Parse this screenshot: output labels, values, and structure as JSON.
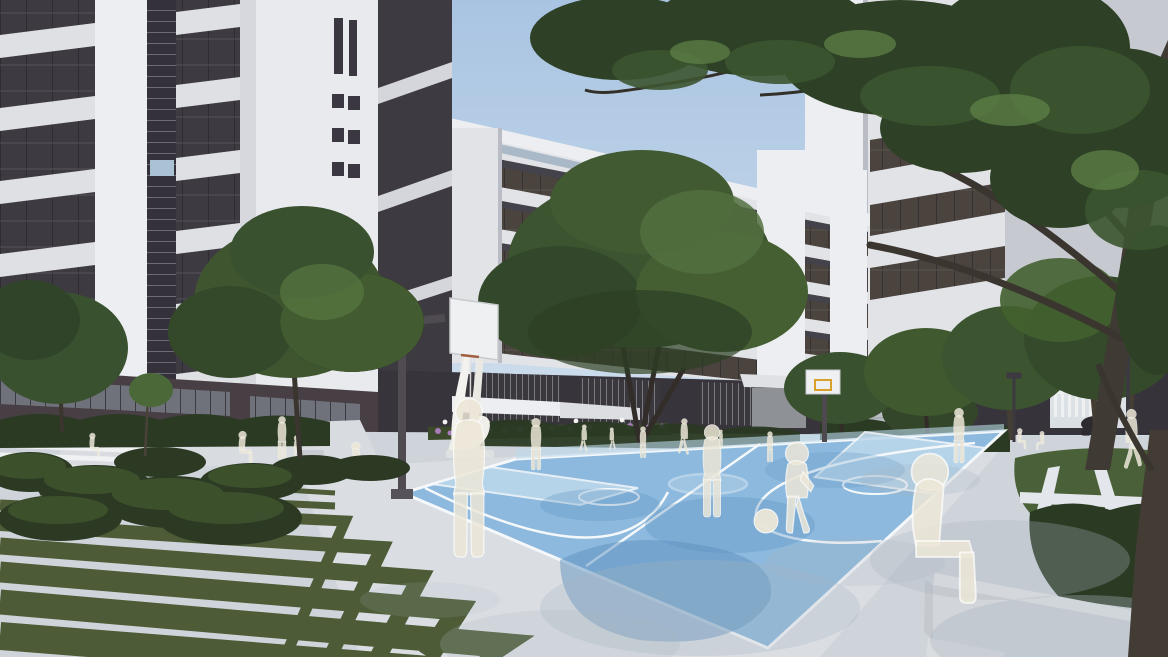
{
  "meta": {
    "title": "Architectural rendering of a campus courtyard with basketball court",
    "style": "3D visualization, no UI text visible"
  },
  "colors": {
    "sky_top": "#a9c4e2",
    "sky_bottom": "#d3e1ee",
    "wall_white": "#e2e3e7",
    "wall_shade": "#c7c9d1",
    "pier_white": "#edeef1",
    "glass_dark": "#3e3a41",
    "glass_brown": "#4a433e",
    "base_dark": "#38343b",
    "base_brown": "#473f44",
    "window_gray": "#70727b",
    "foliage_dark": "#2c3e25",
    "foliage_mid": "#41592f",
    "foliage_light": "#5d7d42",
    "foliage_bright": "#76994f",
    "trunk": "#453e35",
    "trunk_dark": "#322d28",
    "court_blue": "#8cb9dd",
    "court_light": "#bdd8ec",
    "court_shadow": "#5e92bf",
    "line_white": "#f5f8fa",
    "pavement": "#ced4da",
    "pavement_bright": "#dfe3e7",
    "pavement_shadow": "#a9b4c0",
    "grass": "#4d5c36",
    "grass_dark": "#39452a",
    "figure": "#ece6d7",
    "bench_white": "#e7e8ea",
    "bench_side": "#d2d5d9",
    "hedge": "#2a3a23",
    "flower_purple": "#a87cba",
    "lamp": "#f4f4f2",
    "accent_red": "#b04a42",
    "accent_blue": "#4c6ea6",
    "metal_dark": "#4d494f",
    "passage_light": "#d9dee3",
    "scooter": "#2e2b30",
    "backboard_yellow": "#d9a02b"
  },
  "scene": {
    "buildings": [
      "white multi-storey block left",
      "white slab building center",
      "white tower right"
    ],
    "objects": [
      "basketball court",
      "near basketball hoop",
      "far basketball hoop",
      "abstract white sculpture",
      "chevron grass stripes",
      "white concrete bench",
      "flower bed",
      "passage with white fence",
      "parked scooter"
    ],
    "people": "translucent white ghost silhouettes"
  },
  "court": {
    "corners": [
      [
        403,
        493
      ],
      [
        516,
        459
      ],
      [
        1004,
        431
      ],
      [
        768,
        648
      ]
    ],
    "ball": {
      "x": 766,
      "y": 521,
      "r": 12
    }
  },
  "landscape": {
    "grass_strips": [
      {
        "p": [
          [
            118,
            480
          ],
          [
            335,
            493
          ]
        ],
        "w": 5
      },
      {
        "p": [
          [
            40,
            492
          ],
          [
            335,
            506
          ]
        ],
        "w": 7
      },
      {
        "p": [
          [
            0,
            505
          ],
          [
            345,
            521
          ],
          [
            285,
            657
          ]
        ],
        "w": 11
      },
      {
        "p": [
          [
            0,
            524
          ],
          [
            382,
            548
          ],
          [
            330,
            657
          ]
        ],
        "w": 14
      },
      {
        "p": [
          [
            0,
            546
          ],
          [
            420,
            578
          ],
          [
            378,
            657
          ]
        ],
        "w": 17
      },
      {
        "p": [
          [
            0,
            572
          ],
          [
            458,
            610
          ],
          [
            428,
            657
          ]
        ],
        "w": 21
      },
      {
        "p": [
          [
            0,
            602
          ],
          [
            498,
            645
          ],
          [
            480,
            657
          ]
        ],
        "w": 25
      },
      {
        "p": [
          [
            0,
            636
          ],
          [
            530,
            678
          ]
        ],
        "w": 28
      }
    ]
  },
  "figures": [
    {
      "t": "sit",
      "x": 95,
      "y": 457,
      "s": 0.37,
      "f": 1
    },
    {
      "t": "sit",
      "x": 246,
      "y": 463,
      "s": 0.49,
      "f": 1
    },
    {
      "t": "stand",
      "x": 282,
      "y": 459,
      "s": 0.42,
      "f": 1
    },
    {
      "t": "child",
      "x": 297,
      "y": 459,
      "s": 0.4,
      "f": 1
    },
    {
      "t": "sit",
      "x": 352,
      "y": 478,
      "s": 0.55,
      "f": -1
    },
    {
      "t": "stand",
      "x": 469,
      "y": 557,
      "s": 1.56,
      "f": 1
    },
    {
      "t": "stand",
      "x": 536,
      "y": 470,
      "s": 0.51,
      "f": 1
    },
    {
      "t": "walk",
      "x": 584,
      "y": 452,
      "s": 0.27,
      "f": 1
    },
    {
      "t": "walk",
      "x": 612,
      "y": 450,
      "s": 0.22,
      "f": -1
    },
    {
      "t": "stand",
      "x": 643,
      "y": 458,
      "s": 0.31,
      "f": 1
    },
    {
      "t": "walk",
      "x": 684,
      "y": 455,
      "s": 0.36,
      "f": 1
    },
    {
      "t": "stand",
      "x": 712,
      "y": 517,
      "s": 0.91,
      "f": 1
    },
    {
      "t": "child",
      "x": 797,
      "y": 533,
      "s": 1.53,
      "f": 1
    },
    {
      "t": "stand",
      "x": 770,
      "y": 462,
      "s": 0.3,
      "f": 1
    },
    {
      "t": "stand",
      "x": 721,
      "y": 448,
      "s": 0.18,
      "f": 1
    },
    {
      "t": "stand",
      "x": 959,
      "y": 463,
      "s": 0.54,
      "f": 1
    },
    {
      "t": "sit",
      "x": 946,
      "y": 603,
      "s": 2.3,
      "f": 1
    },
    {
      "t": "walk",
      "x": 1132,
      "y": 469,
      "s": 0.59,
      "f": -1
    },
    {
      "t": "sit",
      "x": 1022,
      "y": 449,
      "s": 0.32,
      "f": 1
    },
    {
      "t": "sit",
      "x": 1040,
      "y": 450,
      "s": 0.29,
      "f": -1
    }
  ]
}
